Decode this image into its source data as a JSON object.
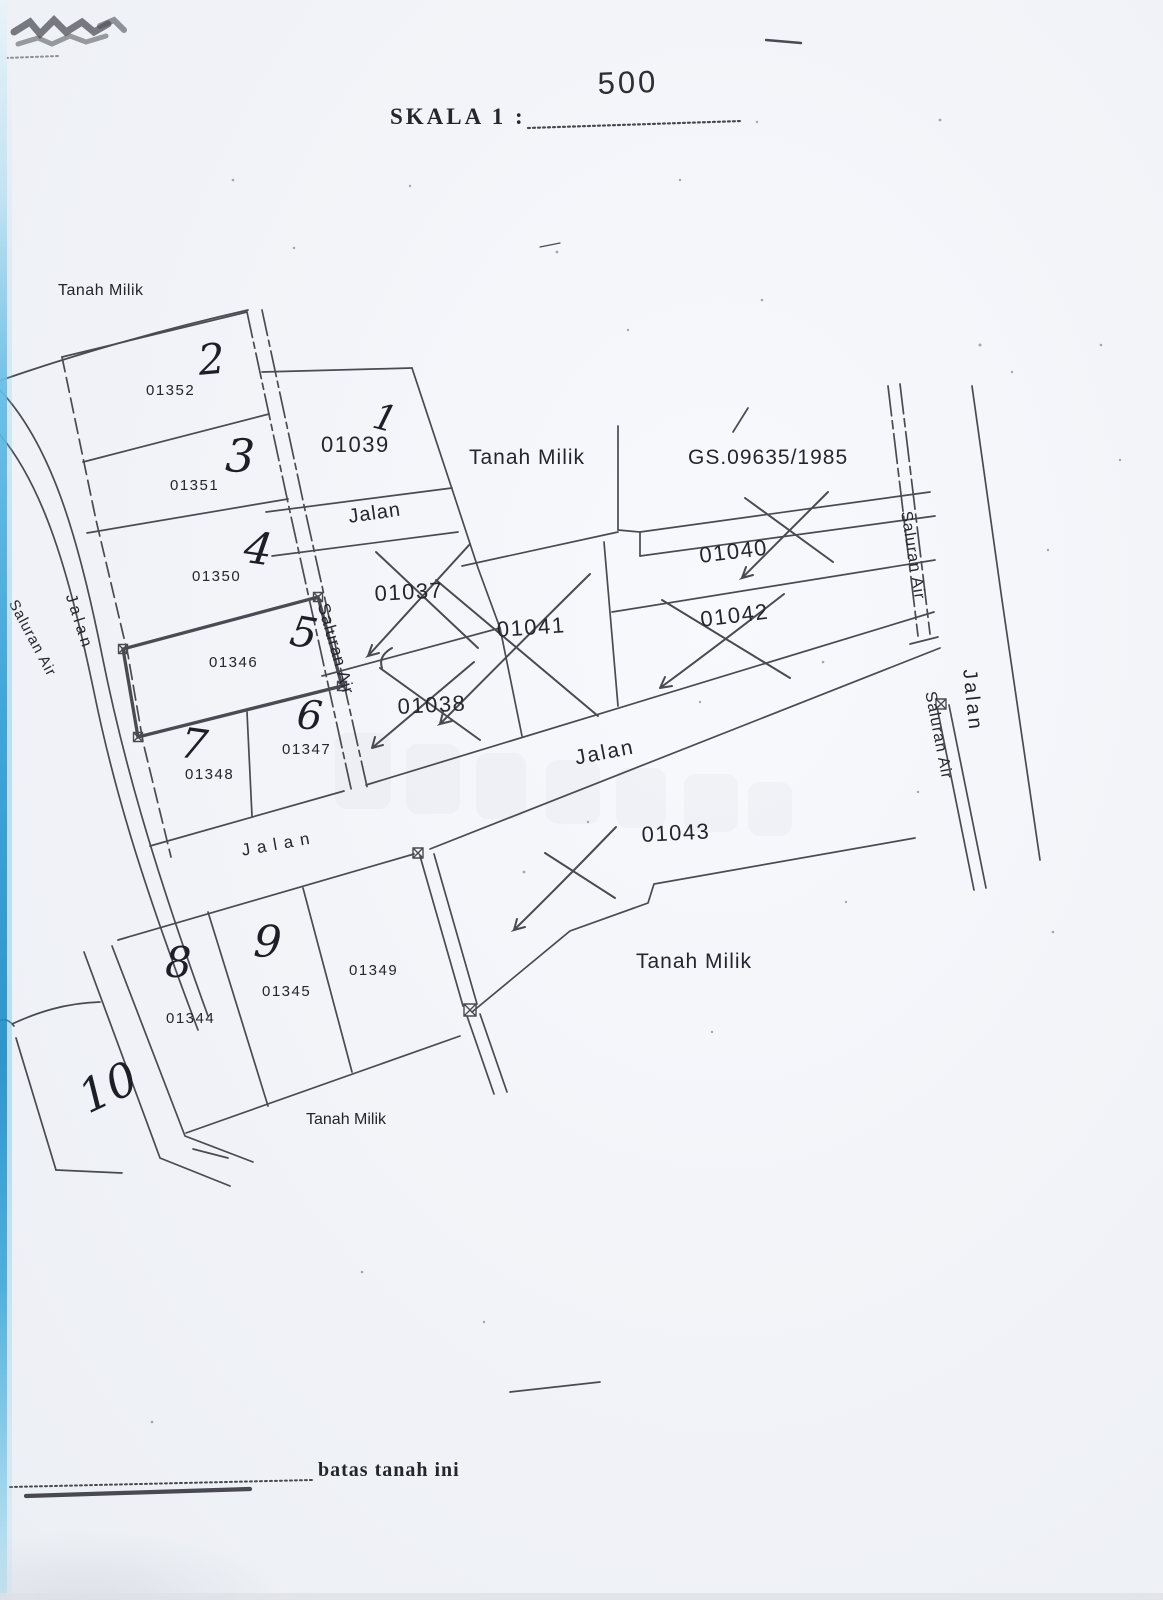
{
  "header": {
    "scale_label": "SKALA 1 :",
    "scale_value": "500"
  },
  "legend": {
    "boundary_label": "batas tanah ini"
  },
  "map": {
    "region_labels": {
      "top_left": "Tanah Milik",
      "middle": "Tanah Milik",
      "bottom_right": "Tanah Milik",
      "bottom_left": "Tanah Milik"
    },
    "document_ref": "GS.09635/1985",
    "roads": {
      "west": "Jalan",
      "upper": "Jalan",
      "middle": "Jalan",
      "lower_left": "Jalan",
      "east": "Jalan"
    },
    "waterways": {
      "far_west": "Saluran Air",
      "central": "Saluran Air",
      "east_upper": "Saluran Air",
      "east_lower": "Saluran Air"
    },
    "parcels": {
      "p01352": {
        "no": "2",
        "id": "01352"
      },
      "p01351": {
        "no": "3",
        "id": "01351"
      },
      "p01350": {
        "no": "4",
        "id": "01350"
      },
      "p01346": {
        "no": "5",
        "id": "01346"
      },
      "p01347": {
        "no": "6",
        "id": "01347"
      },
      "p01348": {
        "no": "7",
        "id": "01348"
      },
      "p01344": {
        "no": "8",
        "id": "01344"
      },
      "p01345": {
        "no": "9",
        "id": "01345"
      },
      "p01349": {
        "id": "01349"
      },
      "p10": {
        "no": "10"
      },
      "p01039": {
        "no": "1",
        "id": "01039"
      },
      "p01037": {
        "id": "01037",
        "crossed_out": true
      },
      "p01038": {
        "id": "01038",
        "crossed_out": true
      },
      "p01040": {
        "id": "01040",
        "crossed_out": true
      },
      "p01041": {
        "id": "01041",
        "crossed_out": true
      },
      "p01042": {
        "id": "01042",
        "crossed_out": true
      },
      "p01043": {
        "id": "01043",
        "crossed_out": true
      }
    }
  }
}
